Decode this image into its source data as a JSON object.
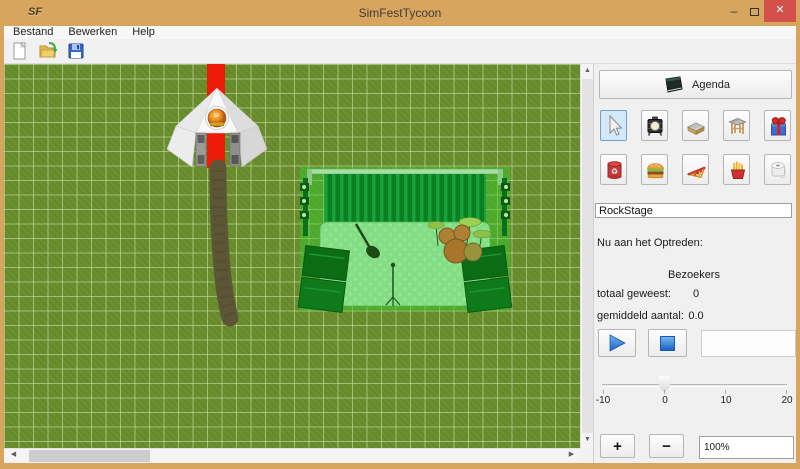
{
  "window": {
    "title": "SimFestTycoon",
    "app_initials": "SF"
  },
  "titlebar": {
    "minimize_glyph": "–",
    "close_glyph": "✕"
  },
  "menubar": {
    "items": [
      {
        "label": "Bestand"
      },
      {
        "label": "Bewerken"
      },
      {
        "label": "Help"
      }
    ]
  },
  "toolbar": {
    "icons": [
      "new-file-icon",
      "open-file-icon",
      "save-file-icon"
    ]
  },
  "panel": {
    "agenda_label": "Agenda",
    "tools_row1": [
      "select-tool",
      "spotlight-tool",
      "stage-deck-tool",
      "truss-tool",
      "gift-tool"
    ],
    "tools_row2": [
      "trash-bin-tool",
      "burger-stand-tool",
      "pizza-stand-tool",
      "fries-stand-tool",
      "toilet-tool"
    ],
    "selected_tool": "select-tool",
    "stage_name_value": "RockStage",
    "now_playing_label": "Nu aan het Optreden:",
    "visitors_header": "Bezoekers",
    "total_label": "totaal geweest:",
    "total_value": "0",
    "average_label": "gemiddeld aantal:",
    "average_value": "0.0",
    "plus_label": "+",
    "minus_label": "−",
    "zoom_value": "100%",
    "slider": {
      "min": -10,
      "max": 20,
      "value": 0,
      "tick_labels": [
        "-10",
        "0",
        "10",
        "20"
      ]
    }
  },
  "canvas": {
    "objects": [
      "entrance-tent",
      "red-carpet",
      "dirt-path",
      "rock-stage"
    ]
  },
  "colors": {
    "titlebar": "#d8a55e",
    "window-border": "#a9813f",
    "close-button": "#d4504b",
    "grass": "#6b8f2e",
    "carpet": "#ee1b0b",
    "path": "#5c5636",
    "stage-tint": "#2ed22e",
    "selected-tool-bg": "#d3e9f9",
    "selected-tool-border": "#6ba3cc",
    "accent-blue": "#2f6fd0"
  }
}
